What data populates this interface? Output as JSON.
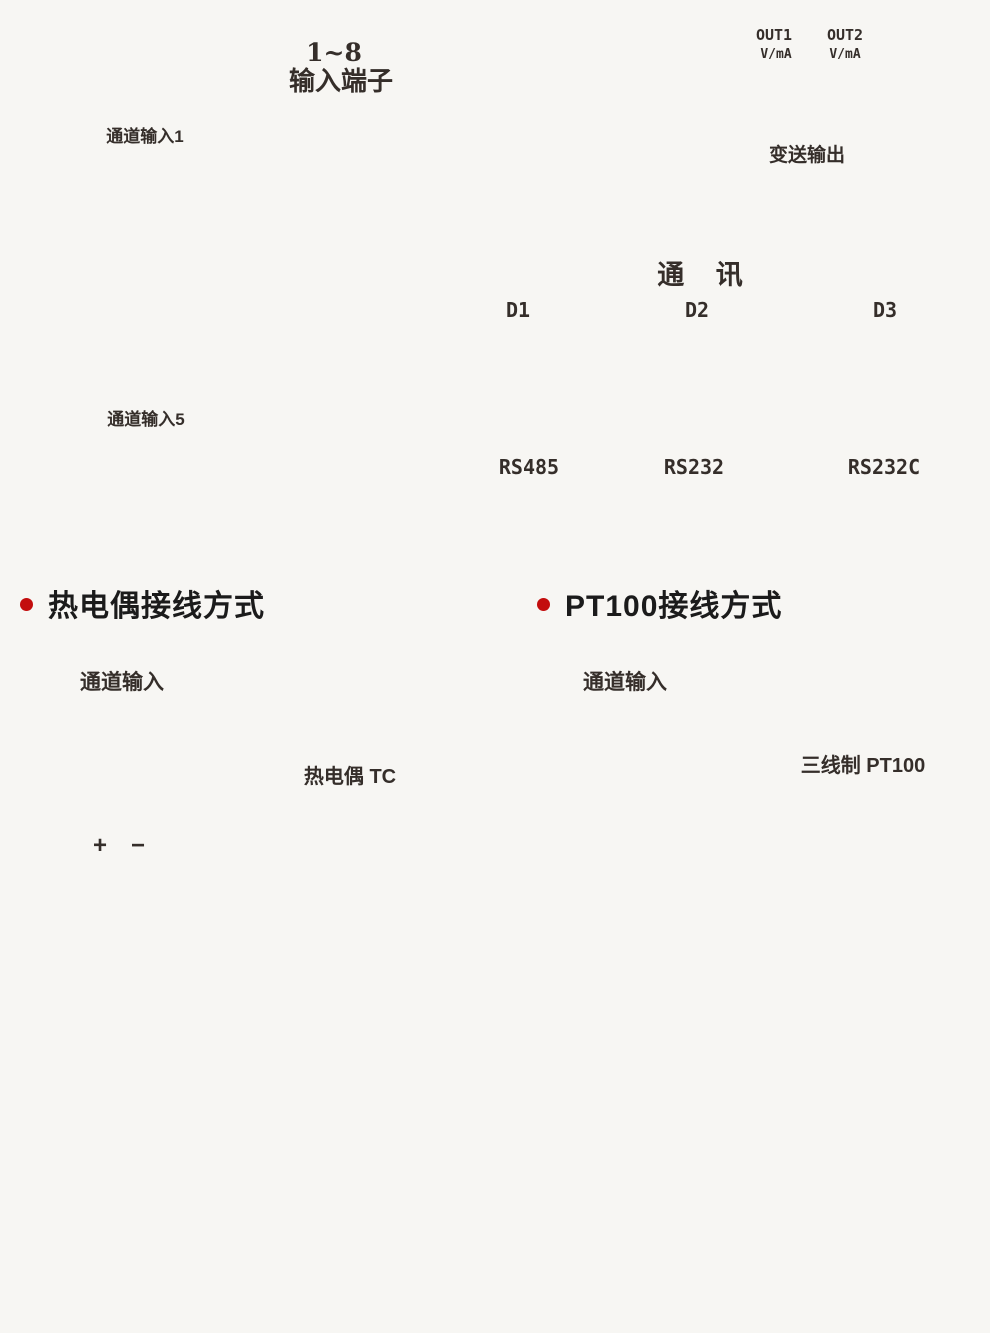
{
  "colors": {
    "line": "#352e2a",
    "wire_pink": "#ec008c",
    "wire_blue": "#29abe2",
    "bullet_red": "#c30d0d",
    "dash_gray": "#9a9a9a"
  },
  "top_panel": {
    "input_label_line1": "1~8",
    "input_label_line2": "输入端子",
    "connector_numbers_top": [
      "1",
      "2",
      "3",
      "4"
    ],
    "connector_numbers_bottom": [
      "5",
      "6",
      "7",
      "8"
    ],
    "output_box": {
      "out1": "OUT1",
      "out2": "OUT2",
      "vma": "V/mA",
      "plus": "+",
      "minus": "−",
      "caption": "变送输出"
    },
    "terminal_numbers": [
      "24",
      "23",
      "22",
      "21",
      "20",
      "19",
      "18",
      "17",
      "16",
      "15",
      "14",
      "13"
    ]
  },
  "channel_box": {
    "terminals": [
      "A",
      "B",
      "C",
      "D",
      "E"
    ],
    "rt_label": "Rt",
    "tc_label": "TC/mV",
    "v_label": "V",
    "ma_label": "mA",
    "plus": "+",
    "minus": "−"
  },
  "balloon": {
    "channel1_title": "通道输入1",
    "channel5_title": "通道输入5"
  },
  "comm_table": {
    "title": "通 讯",
    "columns": [
      {
        "header": "D1",
        "caption": "RS485",
        "rows": [
          {
            "signal": "A",
            "terminal": "13"
          },
          {
            "signal": "B",
            "terminal": "14"
          }
        ]
      },
      {
        "header": "D2",
        "caption": "RS232",
        "rows": [
          {
            "signal": "TXD",
            "terminal": "13"
          },
          {
            "signal": "RXD",
            "terminal": "14"
          },
          {
            "signal": "GND",
            "terminal": "15"
          }
        ]
      },
      {
        "header": "D3",
        "caption": "RS232C",
        "rows": [
          {
            "signal": "TXD",
            "terminal": "13"
          },
          {
            "signal": "RXD",
            "terminal": "14"
          },
          {
            "signal": "GND",
            "terminal": "15"
          }
        ]
      }
    ]
  },
  "sections": {
    "tc": {
      "title": "热电偶接线方式",
      "channel_title": "通道输入",
      "sensor_label": "热电偶 TC",
      "plus": "+",
      "minus": "−"
    },
    "pt": {
      "title": "PT100接线方式",
      "channel_title": "通道输入",
      "sensor_label": "三线制 PT100"
    }
  }
}
